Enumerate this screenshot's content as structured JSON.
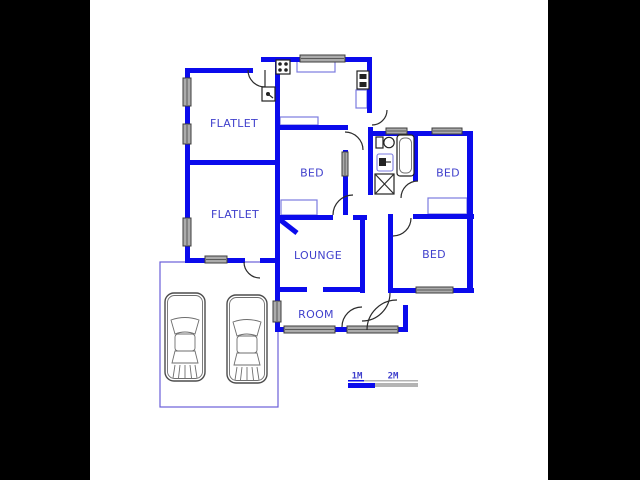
{
  "rooms": [
    {
      "id": "flatlet-1",
      "label": "FLATLET"
    },
    {
      "id": "flatlet-2",
      "label": "FLATLET"
    },
    {
      "id": "bed-middle",
      "label": "BED"
    },
    {
      "id": "bed-top-right",
      "label": "BED"
    },
    {
      "id": "bed-bottom-right",
      "label": "BED"
    },
    {
      "id": "lounge",
      "label": "LOUNGE"
    },
    {
      "id": "room",
      "label": "ROOM"
    }
  ],
  "scale_bar": {
    "m1": "1M",
    "m2": "2M"
  },
  "icons": [
    "stove-icon",
    "oven-icon",
    "geyser-icon",
    "toilet-icon",
    "basin-icon",
    "bathtub-icon",
    "shower-icon",
    "car-icon",
    "car-icon"
  ],
  "colors": {
    "wall": "#0b0bec",
    "thin": "#7b7be0",
    "garage": "#6a5fd8",
    "label": "#4040cc",
    "window_fill": "#ababab",
    "scale_gray": "#b4b4b4",
    "letterbox": "#000000",
    "paper": "#ffffff"
  }
}
